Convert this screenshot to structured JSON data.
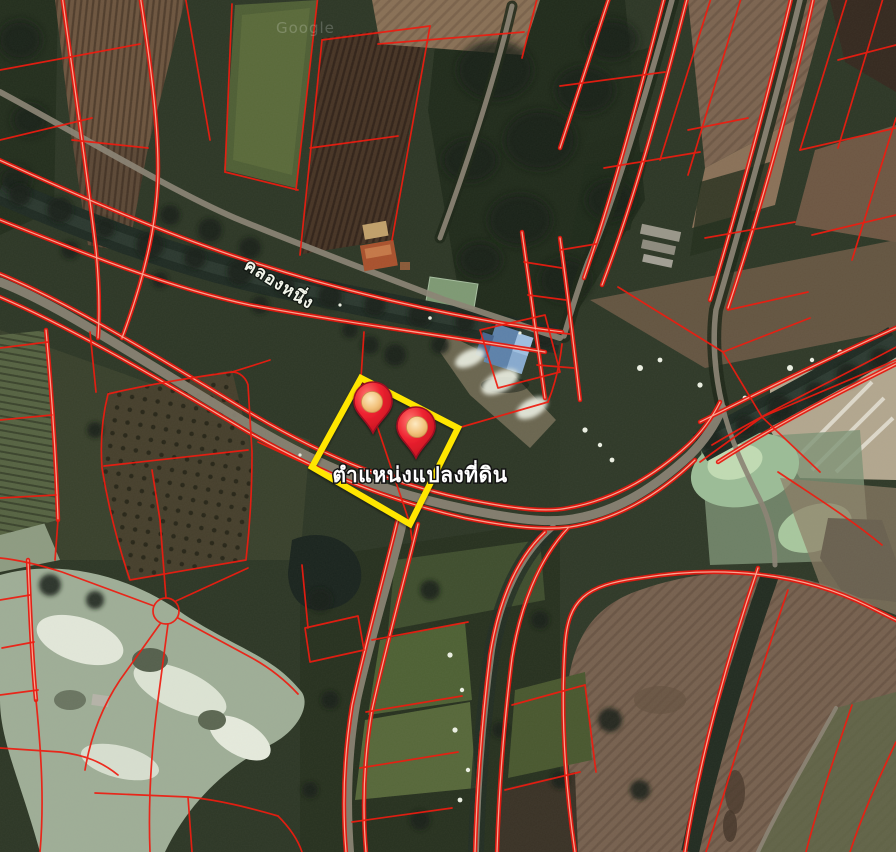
{
  "map": {
    "view": "satellite",
    "watermark": "Google",
    "canal_label": "คลองหนึ่ง",
    "parcel_label": "ตำแหน่งแปลงที่ดิน",
    "markers": {
      "count": 2,
      "body_color": "#ee2230",
      "inner_color": "#f2c27c"
    },
    "overlay": {
      "cadastral_line_color": "#ee1c10",
      "highlight_color": "#ffe600"
    }
  }
}
